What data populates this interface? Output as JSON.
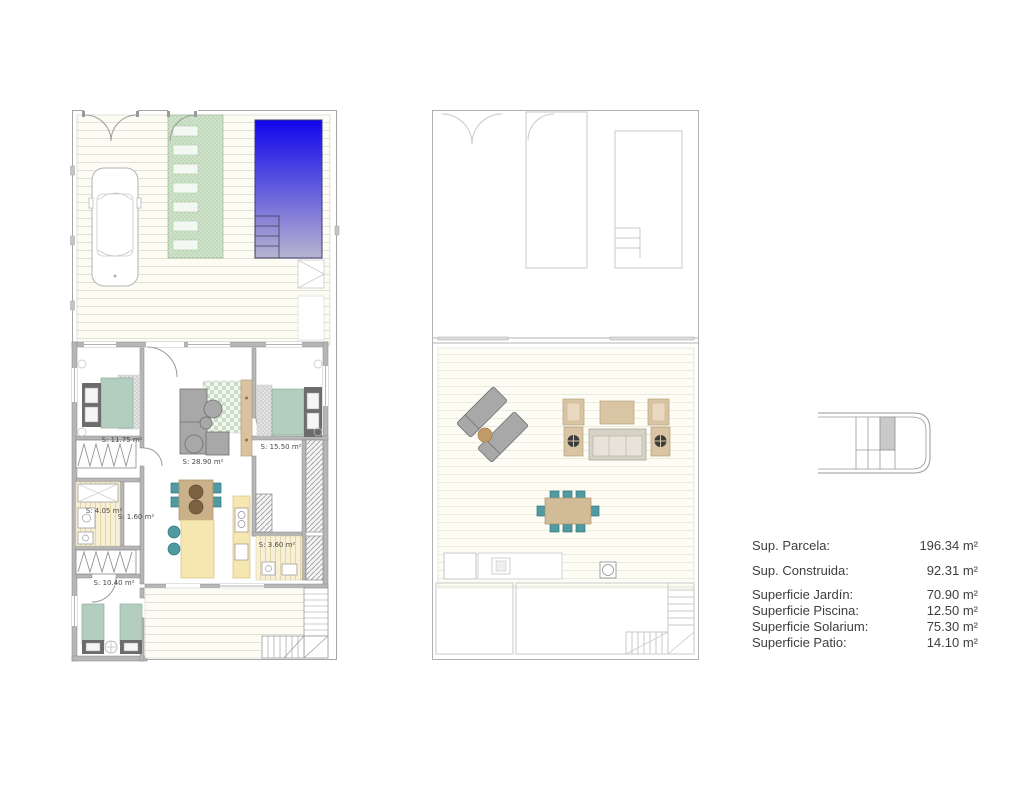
{
  "legend": {
    "rows": [
      {
        "label": "Sup. Parcela:",
        "value": "196.34 m²"
      },
      {
        "label": "Sup. Construida:",
        "value": "92.31 m²"
      },
      {
        "label": "Superficie Jardín:",
        "value": "70.90 m²"
      },
      {
        "label": "Superficie Piscina:",
        "value": "12.50 m²"
      },
      {
        "label": "Superficie Solarium:",
        "value": "75.30 m²"
      },
      {
        "label": "Superficie Patio:",
        "value": "14.10 m²"
      }
    ]
  },
  "ground_floor": {
    "labels": {
      "bedroom_left": "S: 11.75 m²",
      "living": "S: 28.90 m²",
      "bedroom_right": "S: 15.50 m²",
      "bath_left": "S: 4.05 m²",
      "hall": "S: 1.60 m²",
      "bath_right": "S: 3.60 m²",
      "bedroom_bottom": "S: 10.40 m²"
    }
  },
  "colors": {
    "pool_top": "#0f05ec",
    "pool_bottom": "#b7b4cf",
    "garden_path_green": "#cfe2ca",
    "bed_green": "#b3cdbf",
    "chair_teal": "#4f9ba1",
    "wood_tan": "#cbb189",
    "counter_cream": "#f6e6b0",
    "wall_gray": "#b6b6b6"
  }
}
